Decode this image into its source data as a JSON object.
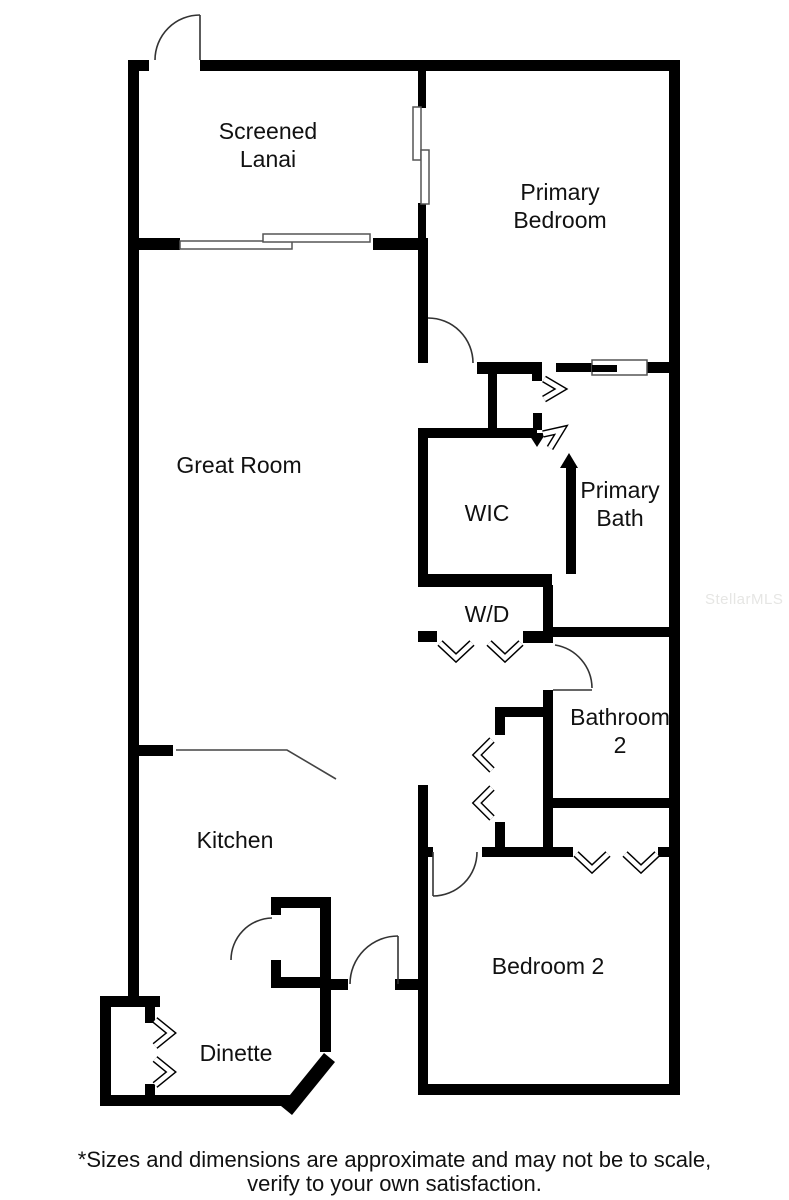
{
  "rooms": {
    "screened_lanai": {
      "line1": "Screened",
      "line2": "Lanai"
    },
    "primary_bedroom": {
      "line1": "Primary",
      "line2": "Bedroom"
    },
    "great_room": {
      "line1": "Great Room"
    },
    "wic": {
      "line1": "WIC"
    },
    "primary_bath": {
      "line1": "Primary",
      "line2": "Bath"
    },
    "laundry": {
      "line1": "W/D"
    },
    "bathroom_2": {
      "line1": "Bathroom",
      "line2": "2"
    },
    "kitchen": {
      "line1": "Kitchen"
    },
    "bedroom_2": {
      "line1": "Bedroom 2"
    },
    "dinette": {
      "line1": "Dinette"
    }
  },
  "watermark": "StellarMLS",
  "disclaimer": {
    "line1": "*Sizes and dimensions are approximate and may not be to scale,",
    "line2": "verify to your own satisfaction."
  },
  "colors": {
    "wall": "#000000",
    "door_arc": "#333333",
    "slider_outline": "#555555",
    "label": "#111111",
    "watermark": "#e6e6e4",
    "background": "#ffffff"
  }
}
